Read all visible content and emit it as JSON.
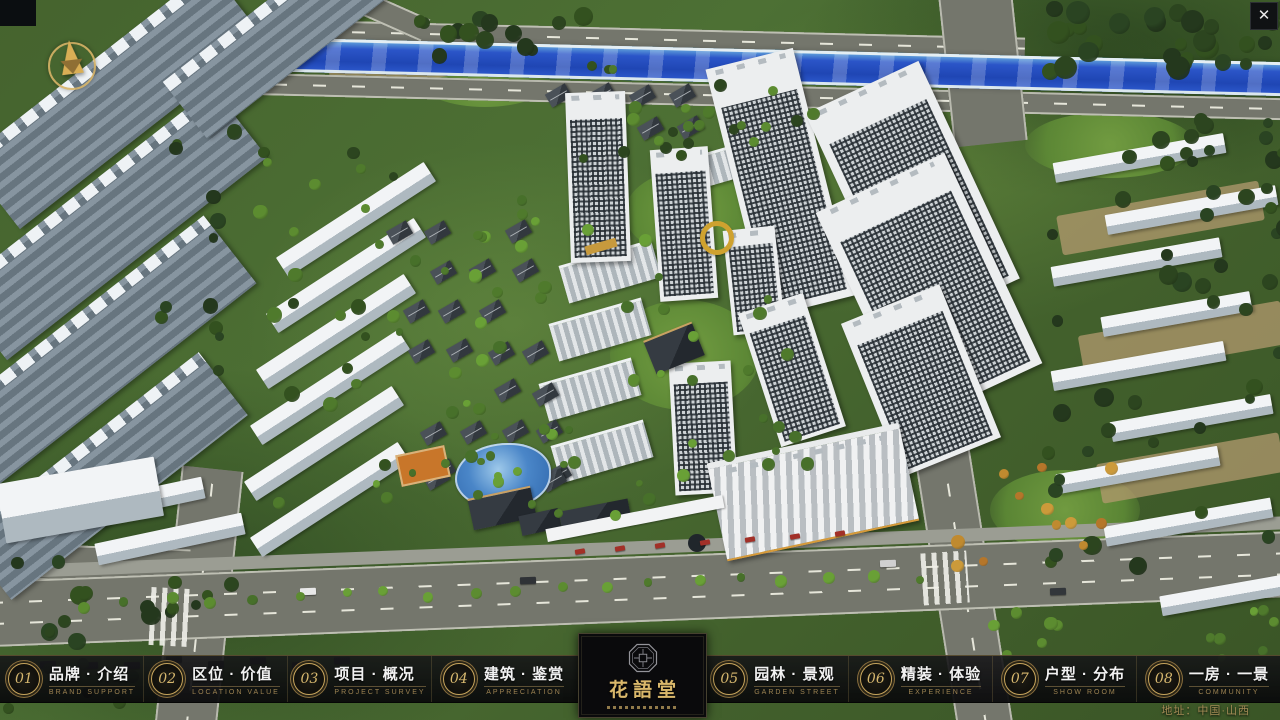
{
  "ui": {
    "close_label": "✕",
    "address": "地址：中国·山西",
    "logo": {
      "title": "花語堂"
    },
    "nav_items": [
      {
        "num": "01",
        "title": "品牌 · 介绍",
        "subtitle": "BRAND SUPPORT"
      },
      {
        "num": "02",
        "title": "区位 · 价值",
        "subtitle": "LOCATION VALUE"
      },
      {
        "num": "03",
        "title": "项目 · 概况",
        "subtitle": "PROJECT SURVEY"
      },
      {
        "num": "04",
        "title": "建筑 · 鉴赏",
        "subtitle": "APPRECIATION"
      },
      {
        "num": "05",
        "title": "园林 · 景观",
        "subtitle": "GARDEN STREET"
      },
      {
        "num": "06",
        "title": "精装 · 体验",
        "subtitle": "EXPERIENCE"
      },
      {
        "num": "07",
        "title": "户型 · 分布",
        "subtitle": "SHOW ROOM"
      },
      {
        "num": "08",
        "title": "一房 · 一景",
        "subtitle": "COMMUNITY"
      }
    ],
    "colors": {
      "gold": "#c6a45c",
      "bar_bg": "rgba(12,12,14,0.9)",
      "river_blue": "#2b55c8"
    }
  }
}
